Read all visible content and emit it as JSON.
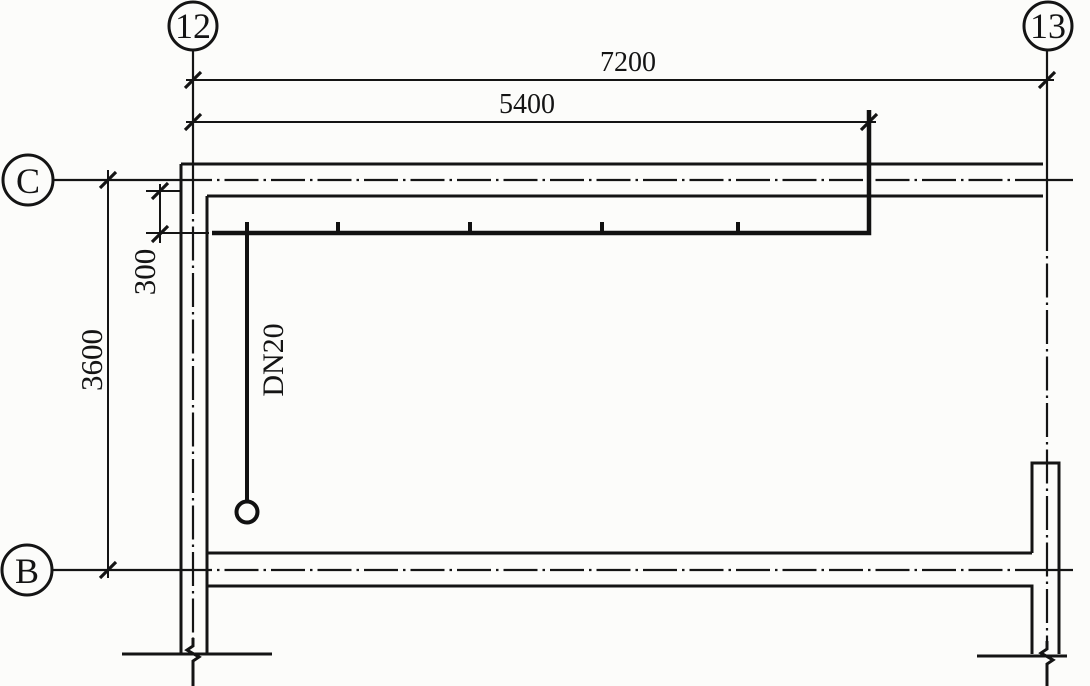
{
  "drawing": {
    "kind": "water-supply-piping-floor-plan",
    "colors": {
      "line": "#141414",
      "paper": "#fcfcfa"
    },
    "axes": {
      "column_left": "12",
      "column_right": "13",
      "row_top": "C",
      "row_bottom": "B"
    },
    "dimensions": {
      "overall_width": "7200",
      "riser_offset": "5400",
      "pipe_to_wall": "300",
      "bay_depth": "3600"
    },
    "pipe": {
      "label": "DN20"
    }
  }
}
